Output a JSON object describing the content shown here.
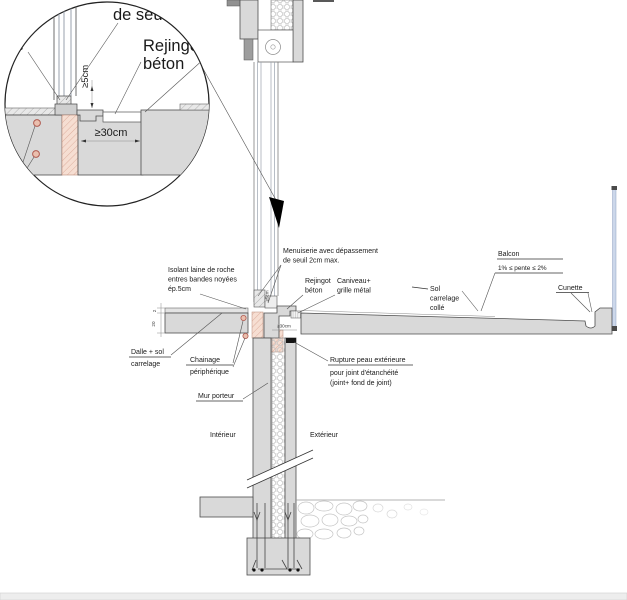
{
  "drawing_title": "Détail seuil de porte-fenêtre sur balcon (coupe technique)",
  "detail_circle": {
    "label_top": "de seuil",
    "label_rejingot_line1": "Rejingot",
    "label_rejingot_line2": "béton",
    "dim_height": "≥5cm",
    "dim_width": "≥30cm",
    "edge_text_fragment": "s"
  },
  "annotations": {
    "menuiserie_line1": "Menuiserie avec dépassement",
    "menuiserie_line2": "de seuil 2cm max.",
    "isolant_line1": "Isolant laine de roche",
    "isolant_line2": "entres bandes noyées",
    "isolant_line3": "ép.5cm",
    "rejingot_line1": "Rejingot",
    "rejingot_line2": "béton",
    "caniveau_line1": "Caniveau+",
    "caniveau_line2": "grille métal",
    "sol_line1": "Sol",
    "sol_line2": "carrelage",
    "sol_line3": "collé",
    "balcon": "Balcon",
    "pente": "1% ≤ pente ≤ 2%",
    "cunette": "Cunette",
    "dalle_line1": "Dalle + sol",
    "dalle_line2": "carrelage",
    "chainage_line1": "Chainage",
    "chainage_line2": "périphérique",
    "mur_porteur": "Mur porteur",
    "interieur": "Intérieur",
    "exterieur": "Extérieur",
    "rupture_line1": "Rupture peau extérieure",
    "rupture_line2": "pour joint d'étanchéité",
    "rupture_line3": "(joint+ fond de joint)"
  },
  "dimensions": {
    "seuil_height": "≥5cm",
    "rejingot_width": "≥30cm",
    "carrelage_thickness": "2",
    "dalle_thickness": "20"
  },
  "colors": {
    "concrete_fill": "#d9d9d9",
    "brick_fill": "#f6ded2",
    "brick_hatch": "#cc8f7d",
    "marker_red": "#b05a50",
    "glass_blue": "#ccd7ea",
    "line_dark": "#333333"
  }
}
